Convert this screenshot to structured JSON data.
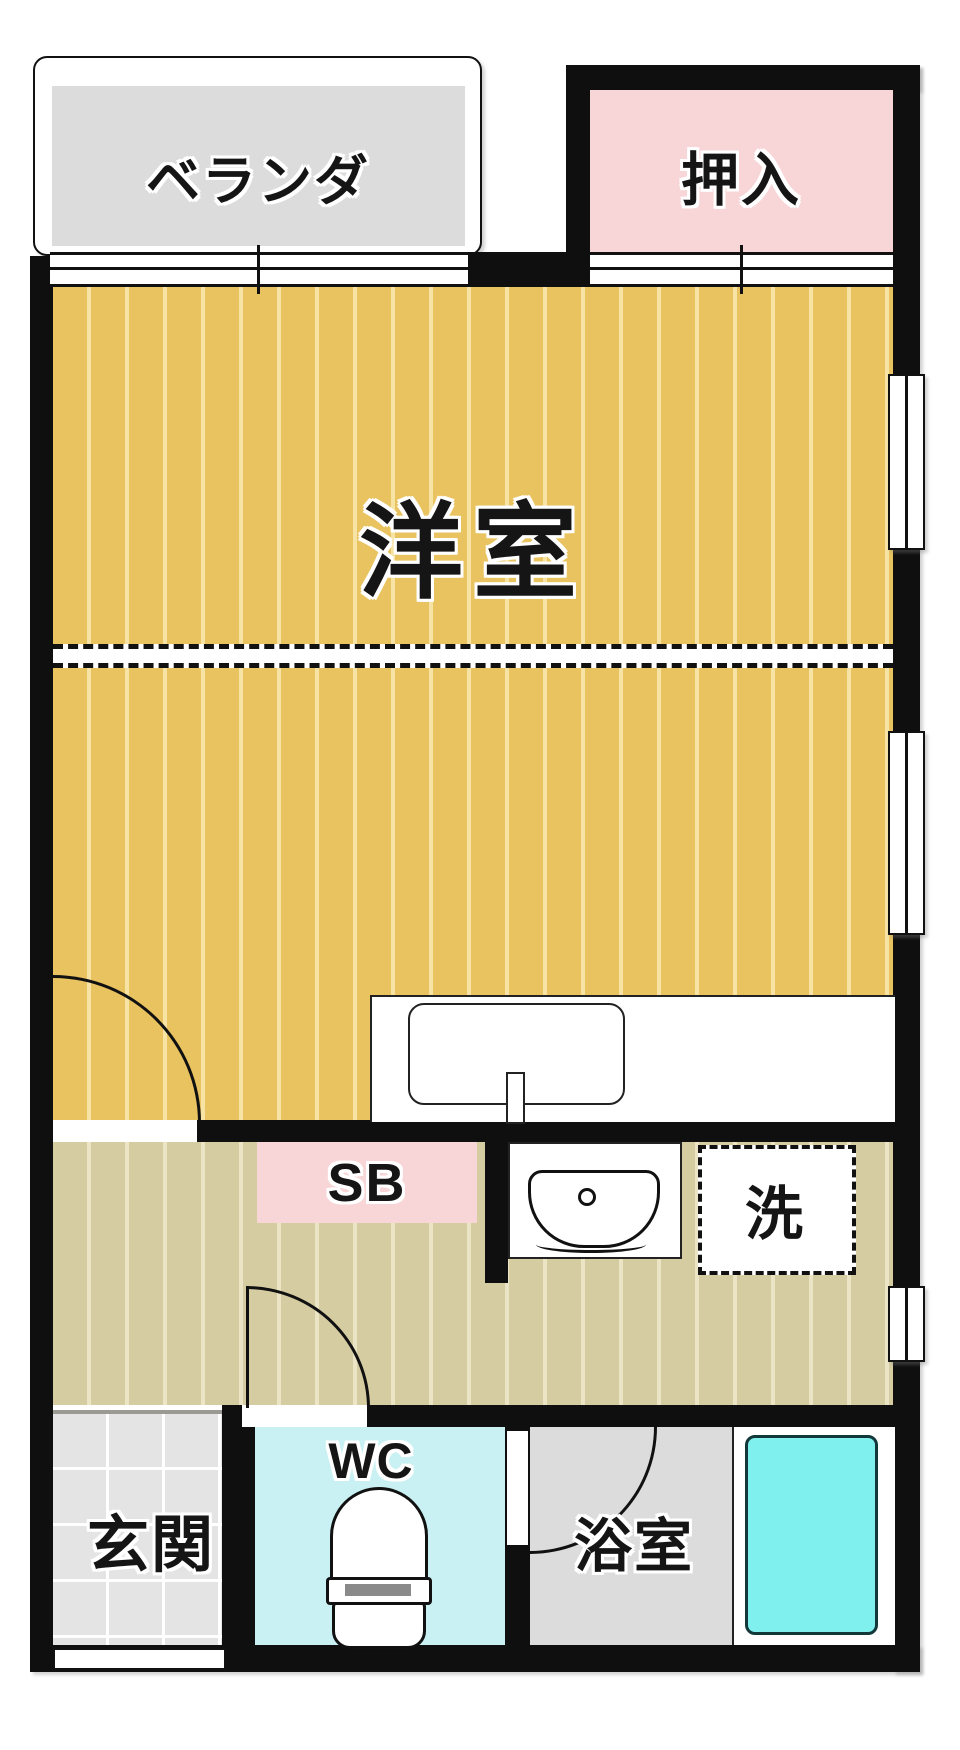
{
  "floor_plan": {
    "rooms": {
      "veranda": {
        "label": "ベランダ"
      },
      "closet": {
        "label": "押入"
      },
      "western_room": {
        "label": "洋室"
      },
      "shoe_box": {
        "label": "SB"
      },
      "laundry_space": {
        "label": "洗"
      },
      "toilet": {
        "label": "WC"
      },
      "entrance": {
        "label": "玄関"
      },
      "bathroom": {
        "label": "浴室"
      }
    },
    "colors": {
      "wall": "#0f0f0f",
      "wood_floor": "#e9c360",
      "wood_floor_stripe": "#f7e3a4",
      "hall_floor": "#d5cca2",
      "hall_floor_stripe": "#ebe5c6",
      "closet_pink": "#f8d5d7",
      "shoe_box_pink": "#f8d5d7",
      "wc_floor_cyan": "#c9f1f3",
      "bathtub_cyan": "#7ff0ee",
      "veranda_gray": "#dcdcdc",
      "bathroom_gray": "#dcdcdc",
      "entrance_tile_gray": "#e4e4e4"
    }
  }
}
